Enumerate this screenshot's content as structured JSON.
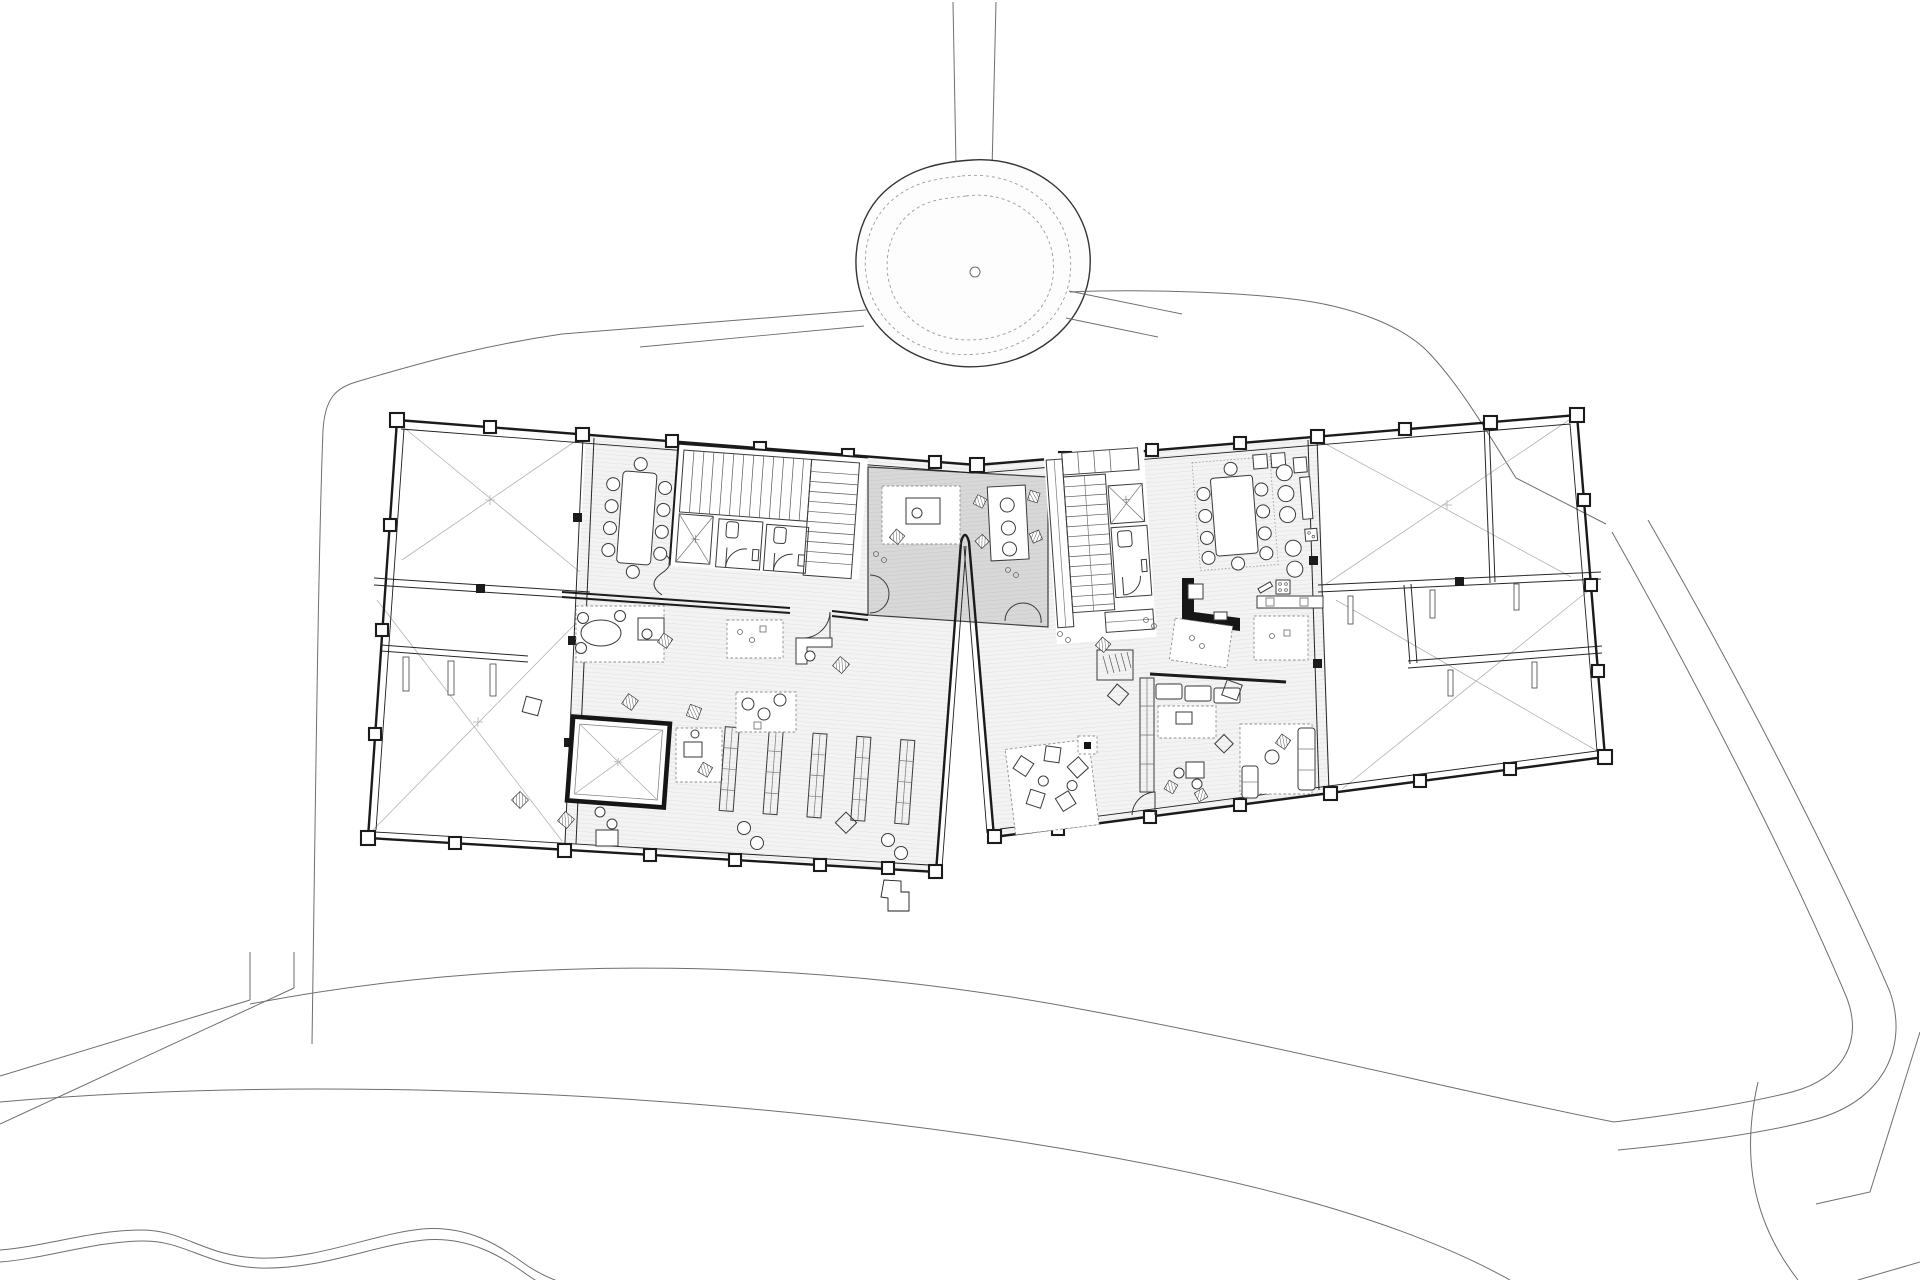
{
  "page": {
    "type": "architectural-floor-plan",
    "title": "Ground floor plan with landscaped site",
    "background": "#ffffff",
    "canvas": {
      "width": 1920,
      "height": 1280
    }
  },
  "colors": {
    "line": "#1b1b1b",
    "site_line": "#6e6e6e",
    "void_diagonal": "#b3b3b3",
    "furniture_line": "#3a3a3a",
    "floor_hatch_bg": "#f3f3f3",
    "floor_hatch_line": "#dcdcdc",
    "junction_bg": "#d8d8d8",
    "junction_line": "#c3c3c3"
  },
  "site": {
    "elements": [
      {
        "name": "north-path",
        "style": "double-line"
      },
      {
        "name": "tree-canopy",
        "style": "solid-outline-with-dashed-rings"
      },
      {
        "name": "tree-trunk",
        "style": "small-circle"
      },
      {
        "name": "site-boundary-west",
        "style": "thin-line"
      },
      {
        "name": "site-boundary-east",
        "style": "thin-line"
      },
      {
        "name": "pedestrian-loop-upper",
        "style": "curved-path"
      },
      {
        "name": "pedestrian-loop-lower",
        "style": "curved-path"
      },
      {
        "name": "diagonal-path-southeast",
        "style": "double-line"
      },
      {
        "name": "meandering-path-southwest",
        "style": "double-wavy-line"
      },
      {
        "name": "path-branch-west",
        "style": "double-line"
      },
      {
        "name": "plaza-edge-southeast",
        "style": "arc-and-lines"
      }
    ]
  },
  "building": {
    "junction": {
      "label": "shared-lounge-bridge",
      "features": [
        "gray-hatched-floor",
        "ramp-slot-between-wings",
        "entrance-stub-south",
        "double-door-west",
        "double-door-south",
        "work-table-3-seats",
        "rug-with-desk"
      ]
    },
    "west_wing": {
      "label": "west-wing",
      "features": [
        "two-void-bays-with-diagonals",
        "structural-beams-with-columns",
        "stair-core",
        "elevator",
        "two-wc-rooms",
        "conference-table-10-chairs",
        "oval-meeting-table",
        "square-skylight-void",
        "five-shelving-rows",
        "reading-poufs",
        "rugs",
        "plants",
        "planter-strip"
      ]
    },
    "east_wing": {
      "label": "east-wing",
      "features": [
        "conference-table-10-chairs-on-rug",
        "kitchen-counter-with-stools",
        "kitchenette-L",
        "coat-rack",
        "shelf-wall",
        "sofa-row",
        "lounge-sofas",
        "bean-bag-rug",
        "stair-core",
        "elevator",
        "wc",
        "bench",
        "void-bays-with-diagonals",
        "planters"
      ]
    }
  }
}
